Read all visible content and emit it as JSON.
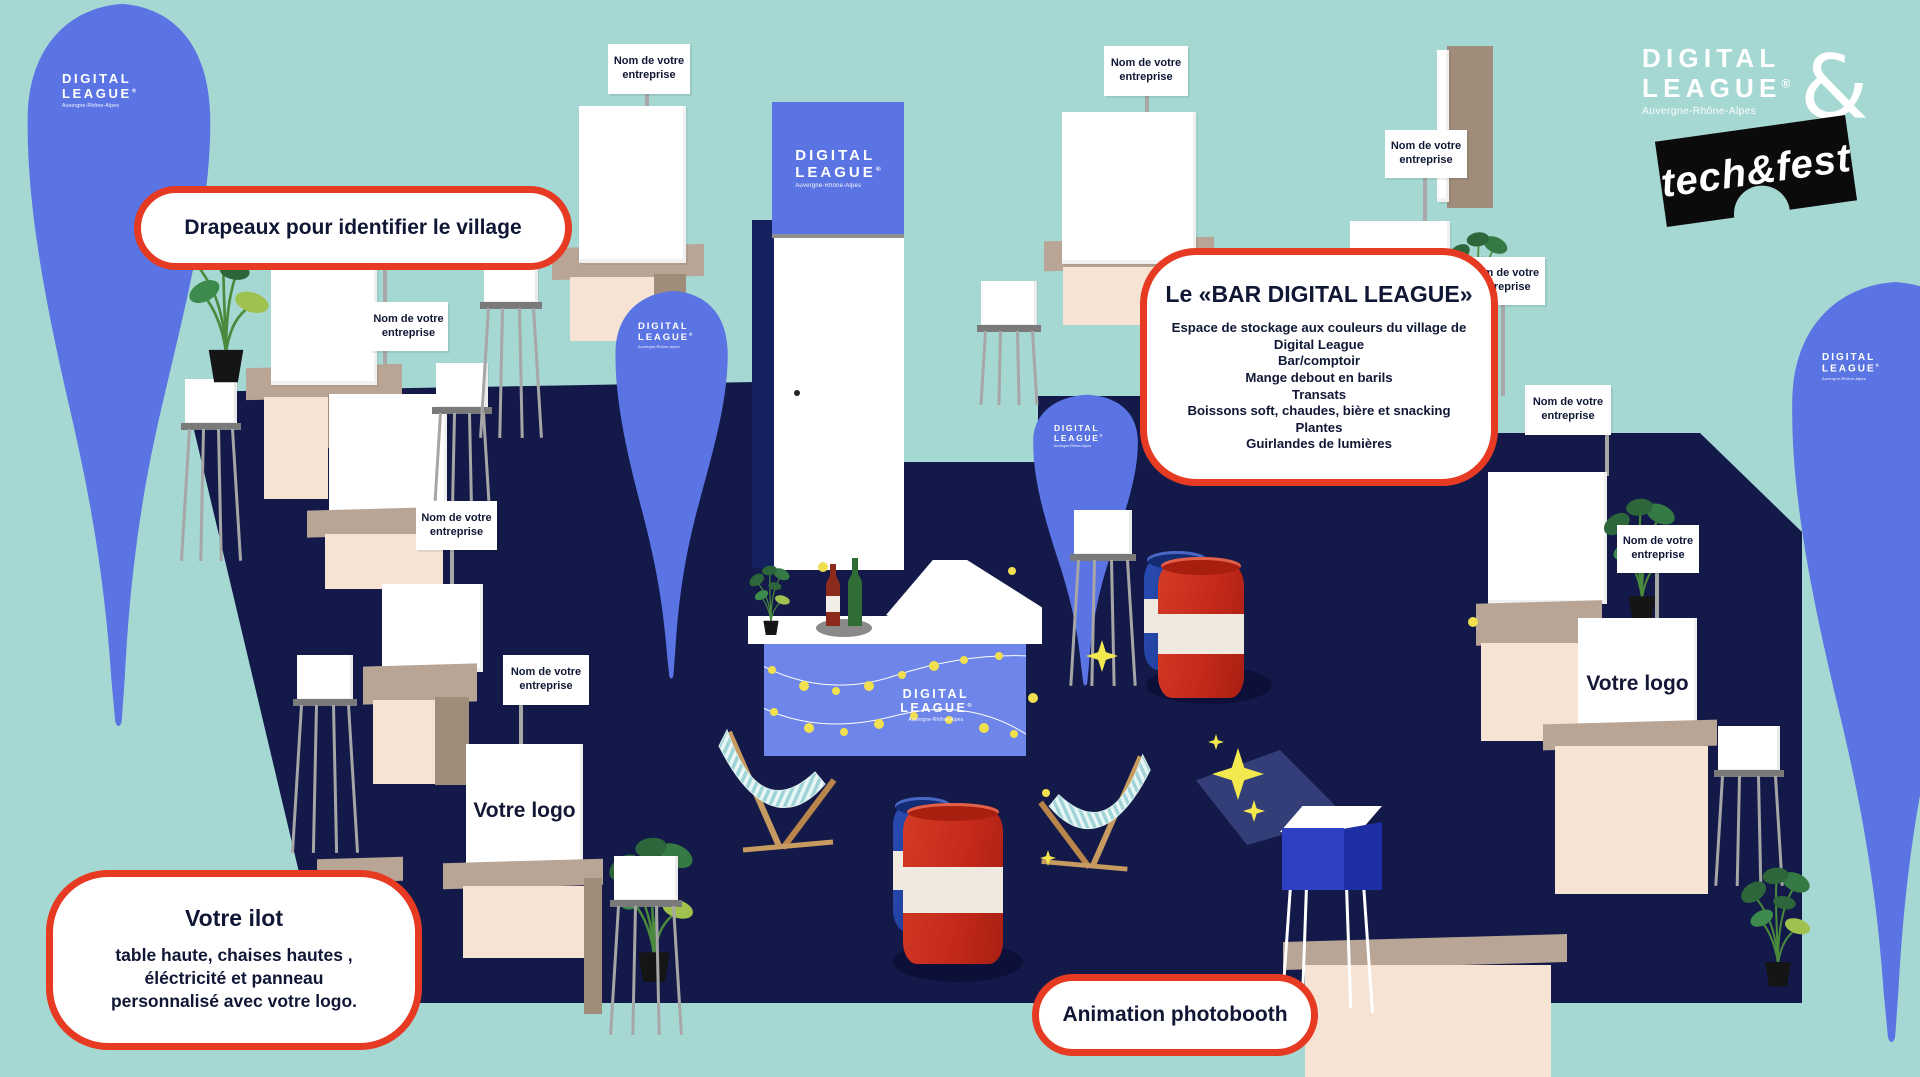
{
  "scene": {
    "company_label": "Nom de votre entreprise",
    "your_logo": "Votre logo"
  },
  "callouts": {
    "flags": {
      "text": "Drapeaux pour identifier le village"
    },
    "bar": {
      "title": "Le «BAR DIGITAL LEAGUE»",
      "lines": [
        "Espace de stockage aux couleurs du village de",
        "Digital League",
        "Bar/comptoir",
        "Mange debout en barils",
        "Transats",
        "Boissons soft, chaudes, bière et snacking",
        "Plantes",
        "Guirlandes de lumières"
      ]
    },
    "ilot": {
      "title": "Votre ilot",
      "lines": [
        "table haute, chaises hautes ,",
        "éléctricité et panneau",
        "personnalisé avec votre logo."
      ]
    },
    "photobooth": {
      "text": "Animation photobooth"
    }
  },
  "brand": {
    "digital_league": {
      "line1": "DIGITAL",
      "line2": "LEAGUE",
      "reg": "®",
      "region": "Auvergne-Rhône-Alpes"
    },
    "ampersand": "&",
    "techfest": "tech&fest"
  },
  "colors": {
    "background": "#a6d8d3",
    "floor_navy": "#131a4a",
    "flag_blue": "#5b74e3",
    "bar_blue": "#6e86e9",
    "callout_border_red": "#e63a22",
    "text_navy": "#101735",
    "barrel_red": "#c52a1b",
    "barrel_blue": "#1d3e9e",
    "photobooth_blue": "#2e41c4",
    "sparkle_yellow": "#f3e84e",
    "booth_tan": "#b9a595",
    "booth_beige": "#f6e3d3"
  }
}
